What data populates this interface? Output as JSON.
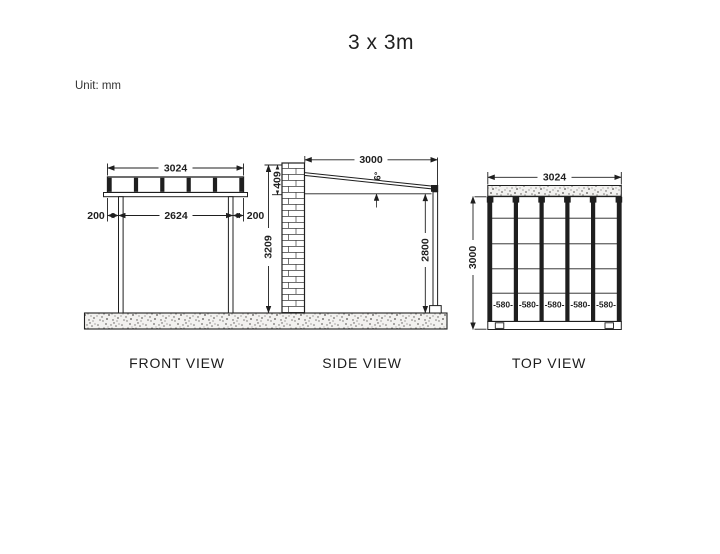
{
  "title": "3 x 3m",
  "unit_label": "Unit: mm",
  "colors": {
    "line": "#1f1f1f",
    "ground_fill": "#f2f1ef",
    "speckle": "#6f6d6a"
  },
  "views": {
    "front": {
      "label": "FRONT VIEW",
      "dims": {
        "overall_width": "3024",
        "left_overhang": "200",
        "clear_span": "2624",
        "right_overhang": "200"
      }
    },
    "side": {
      "label": "SIDE VIEW",
      "dims": {
        "depth": "3000",
        "roof_rise": "409",
        "roof_angle": "6°",
        "wall_height": "3209",
        "post_height": "2800"
      }
    },
    "top": {
      "label": "TOP VIEW",
      "dims": {
        "overall_width": "3024",
        "overall_depth": "3000"
      },
      "bay_labels": [
        "-580-",
        "-580-",
        "-580-",
        "-580-",
        "-580-"
      ]
    }
  }
}
